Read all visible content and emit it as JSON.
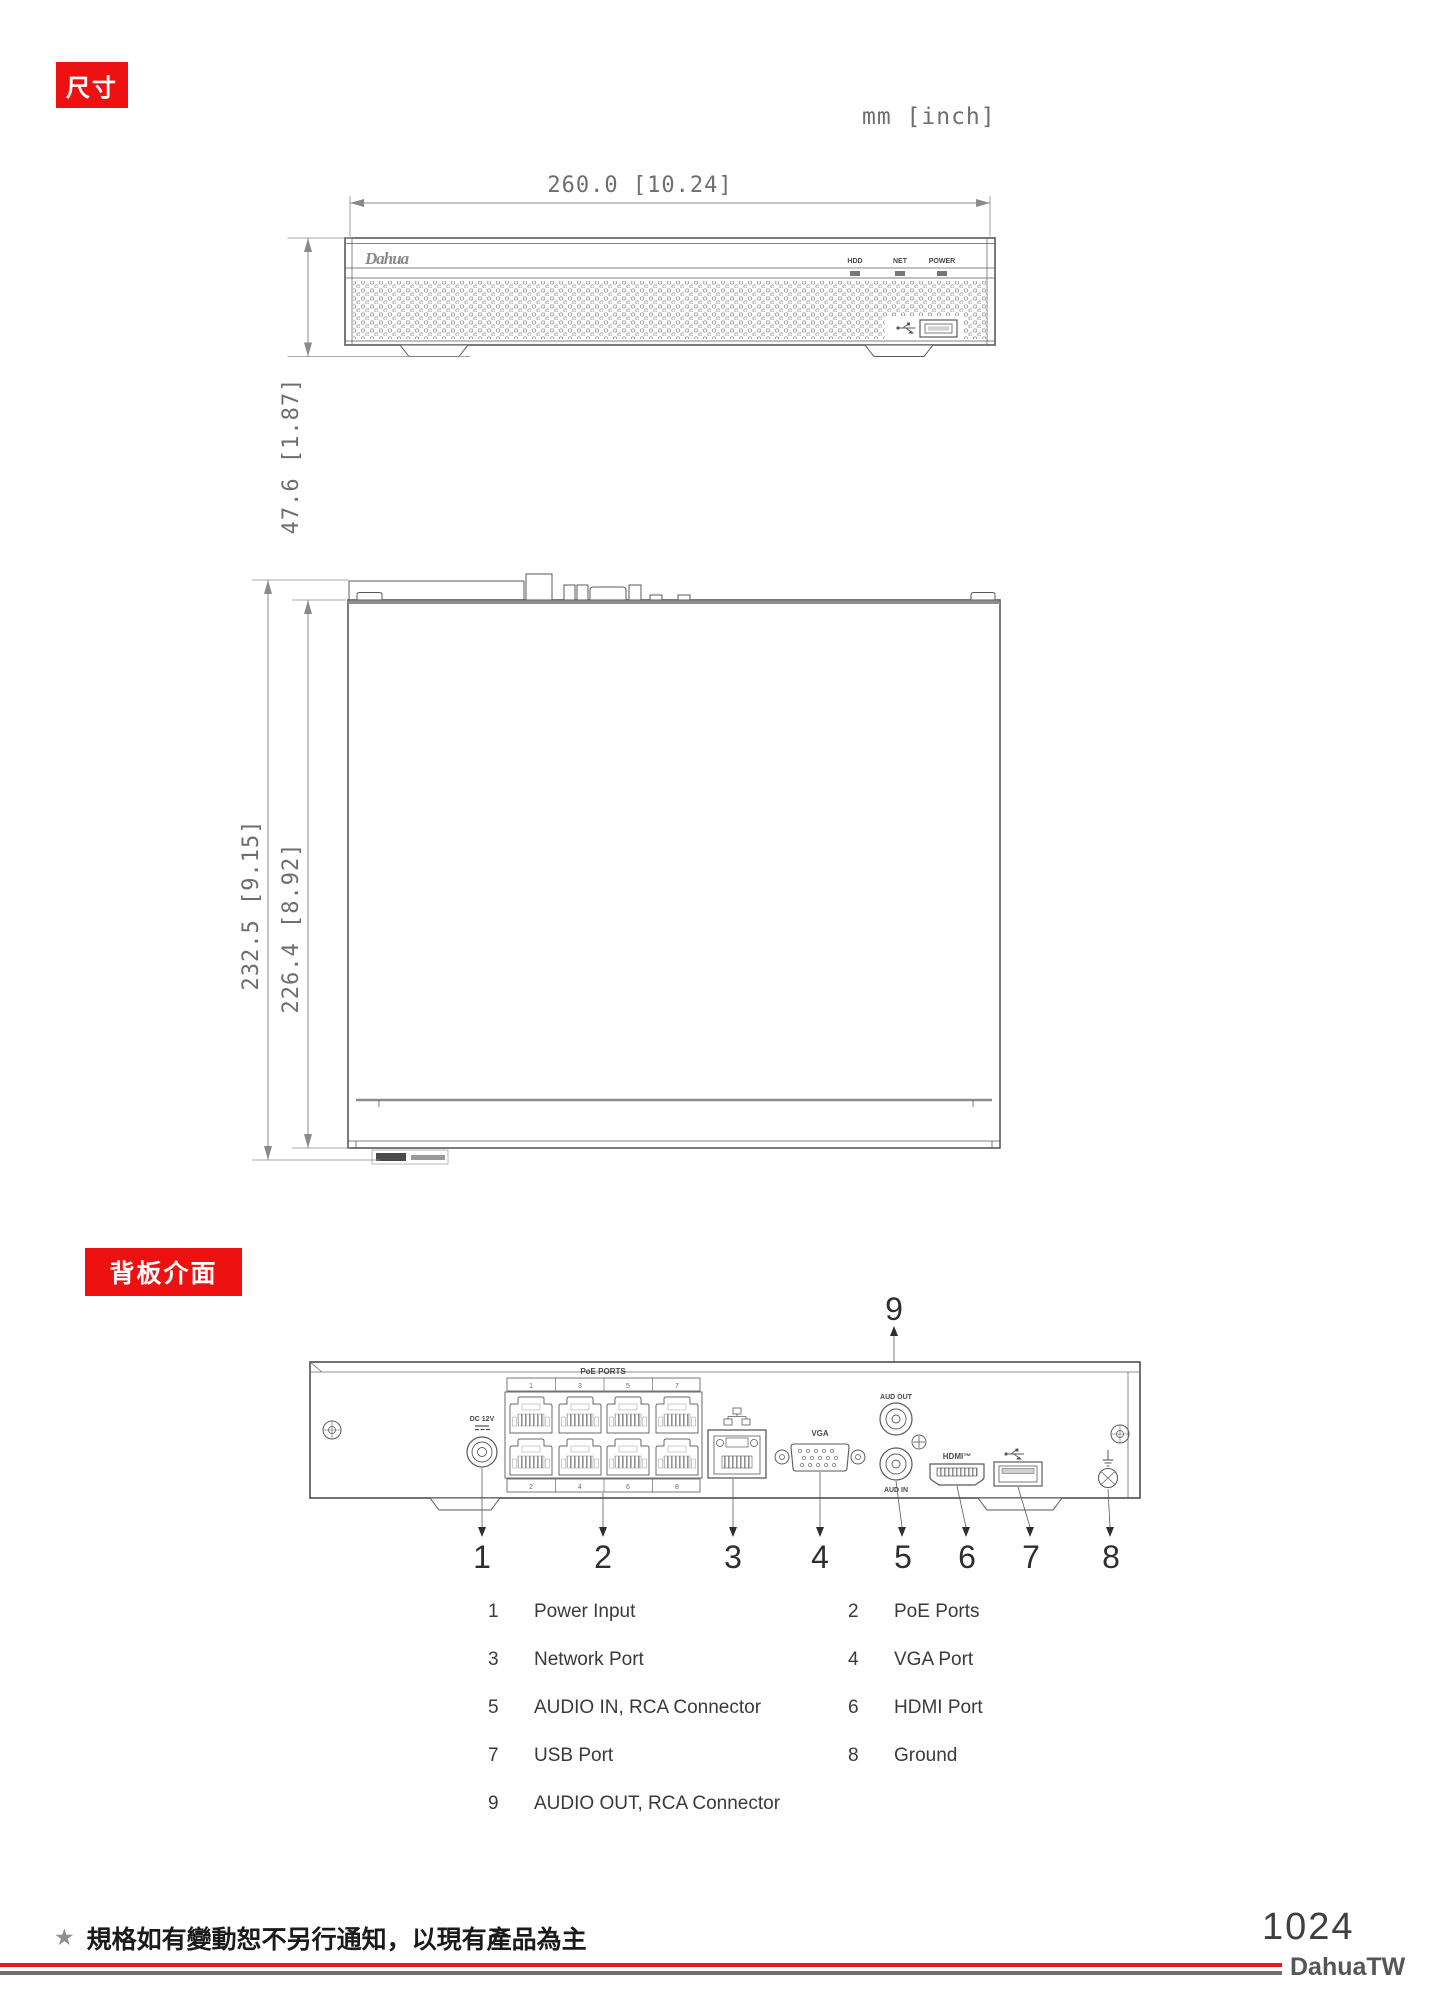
{
  "badges": {
    "dimensions": "尺寸",
    "back_panel": "背板介面"
  },
  "units_label": "mm [inch]",
  "front_view": {
    "width_dim": "260.0 [10.24]",
    "height_dim": "47.6 [1.87]",
    "logo": "Dahua",
    "led_labels": [
      "HDD",
      "NET",
      "POWER"
    ]
  },
  "top_view": {
    "outer_depth_dim": "232.5 [9.15]",
    "inner_depth_dim": "226.4 [8.92]"
  },
  "back_panel": {
    "poe_label": "PoE PORTS",
    "dc_label": "DC 12V",
    "vga_label": "VGA",
    "hdmi_label": "HDMI™",
    "audio_out_label": "AUD OUT",
    "audio_in_label": "AUD IN",
    "poe_top_numbers": [
      "1",
      "3",
      "5",
      "7"
    ],
    "poe_bottom_numbers": [
      "2",
      "4",
      "6",
      "8"
    ],
    "callouts": [
      "1",
      "2",
      "3",
      "4",
      "5",
      "6",
      "7",
      "8",
      "9"
    ]
  },
  "legend": {
    "items": [
      {
        "num": "1",
        "label": "Power Input"
      },
      {
        "num": "2",
        "label": "PoE Ports"
      },
      {
        "num": "3",
        "label": "Network Port"
      },
      {
        "num": "4",
        "label": "VGA Port"
      },
      {
        "num": "5",
        "label": "AUDIO IN, RCA Connector"
      },
      {
        "num": "6",
        "label": "HDMI Port"
      },
      {
        "num": "7",
        "label": "USB Port"
      },
      {
        "num": "8",
        "label": "Ground"
      },
      {
        "num": "9",
        "label": "AUDIO OUT, RCA Connector"
      }
    ]
  },
  "footer": {
    "star": "★",
    "note": "規格如有變動恕不另行通知，以現有產品為主",
    "page_number": "1024",
    "brand": "DahuaTW"
  },
  "colors": {
    "badge_red": "#ee1111",
    "rule_red": "#e8191f",
    "rule_gray": "#6d6e71"
  }
}
